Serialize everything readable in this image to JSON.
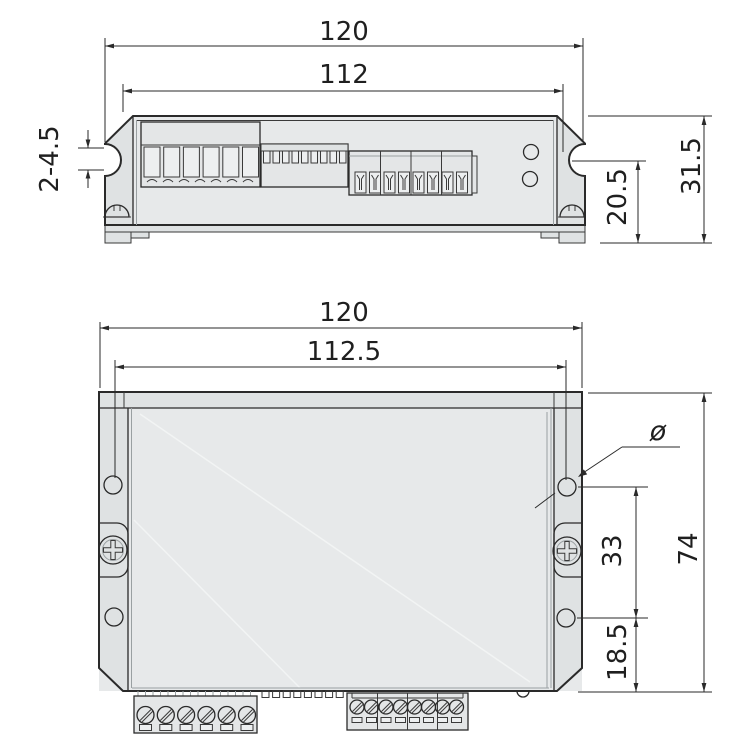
{
  "drawing": {
    "description": "two-view dimensioned mechanical drawing of a drive controller enclosure",
    "colors": {
      "line": "#2a2a2a",
      "body_fill": "#e7e9ea",
      "flange_fill": "#dfe2e3",
      "background": "#ffffff"
    },
    "top_view": {
      "dim_overall_width": "120",
      "dim_inner_width": "112",
      "dim_mount_slot": "2-4.5",
      "dim_slot_to_base": "20.5",
      "dim_overall_height": "31.5"
    },
    "bottom_view": {
      "dim_overall_width": "120",
      "dim_hole_span": "112.5",
      "dim_hole_diameter_symbol": "ø",
      "dim_hole_spacing": "33",
      "dim_overall_depth": "74",
      "dim_hole_to_edge": "18.5"
    }
  }
}
